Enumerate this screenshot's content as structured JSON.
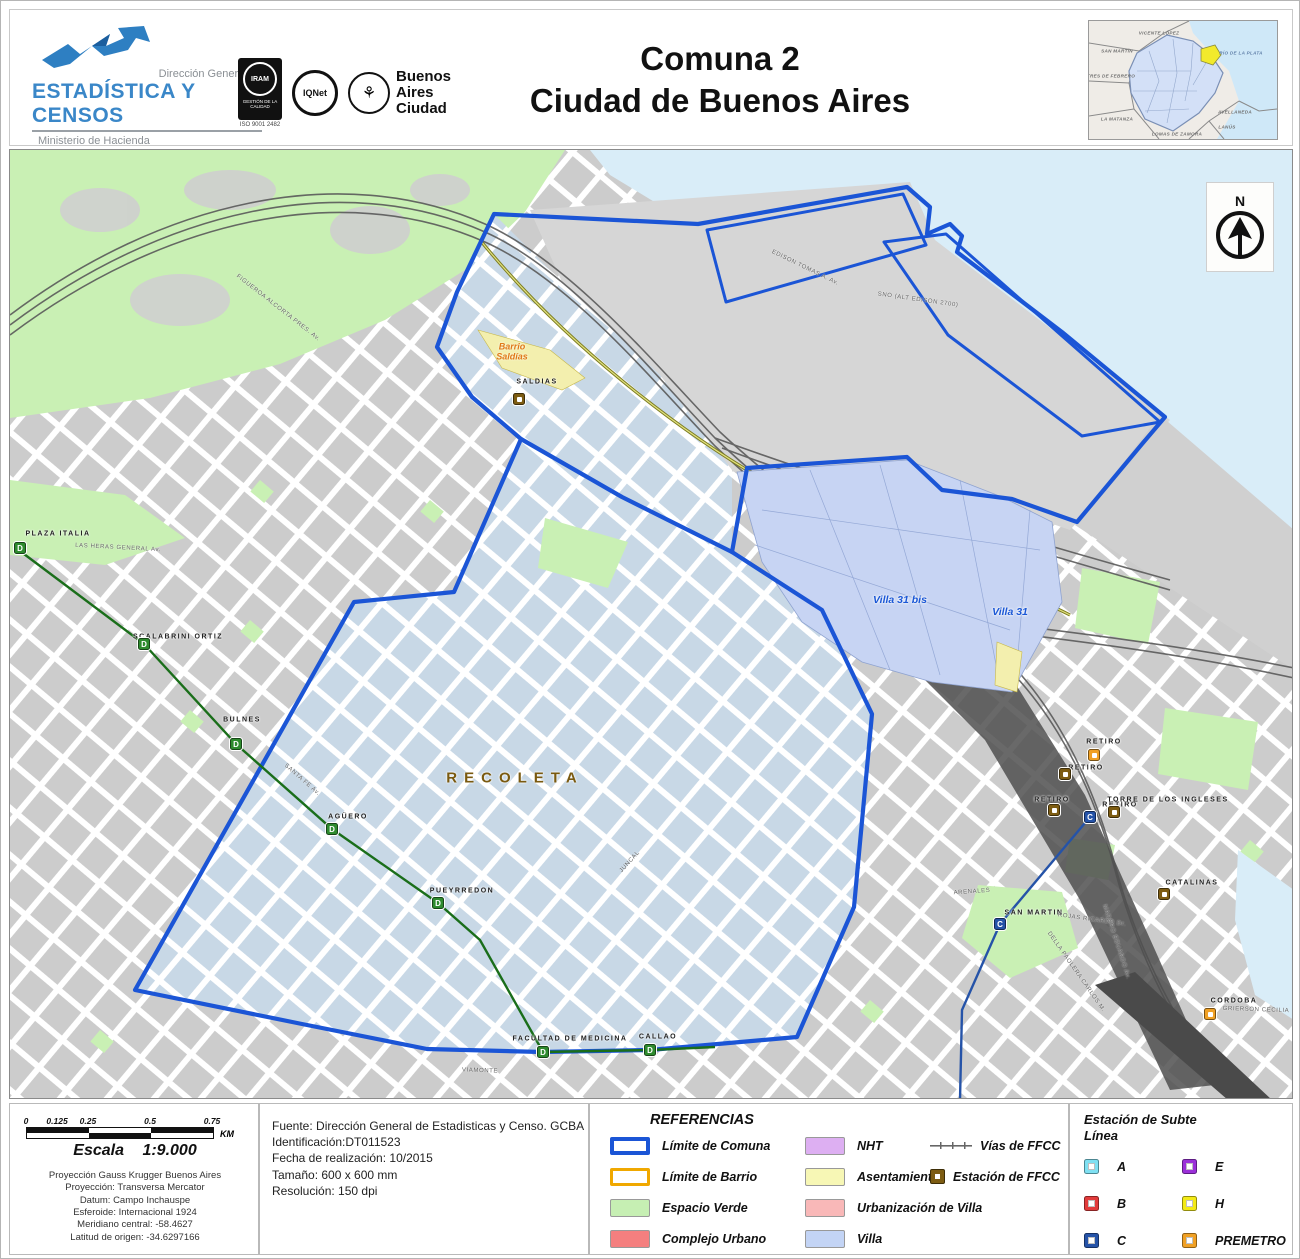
{
  "header": {
    "logo": {
      "line1": "Dirección General de",
      "line2": "ESTADÍSTICA Y CENSOS",
      "line3": "Ministerio de Hacienda"
    },
    "certs": {
      "iram": "IRAM",
      "iram_band": "GESTIÓN DE LA CALIDAD",
      "iram_code": "ISO 9001 2482",
      "iqnet": "IQNet",
      "ba1": "Buenos",
      "ba2": "Aires",
      "ba3": "Ciudad"
    },
    "title1": "Comuna 2",
    "title2": "Ciudad de Buenos Aires",
    "inset": {
      "labels": [
        {
          "text": "VICENTE LÓPEZ",
          "x": 70,
          "y": 12,
          "cls": ""
        },
        {
          "text": "SAN MARTÍN",
          "x": 28,
          "y": 30,
          "cls": ""
        },
        {
          "text": "TRES DE FEBRERO",
          "x": 22,
          "y": 55,
          "cls": ""
        },
        {
          "text": "LA MATANZA",
          "x": 28,
          "y": 98,
          "cls": ""
        },
        {
          "text": "LOMAS DE ZAMORA",
          "x": 88,
          "y": 113,
          "cls": ""
        },
        {
          "text": "LANÚS",
          "x": 138,
          "y": 106,
          "cls": ""
        },
        {
          "text": "AVELLANEDA",
          "x": 146,
          "y": 91,
          "cls": ""
        },
        {
          "text": "RÍO DE LA PLATA",
          "x": 152,
          "y": 32,
          "cls": "wl"
        }
      ]
    }
  },
  "north": {
    "label": "N"
  },
  "map": {
    "labels": [
      {
        "text": "RECOLETA",
        "x": 505,
        "y": 628,
        "cls": "region",
        "rot": 0
      },
      {
        "text": "Villa 31 bis",
        "x": 890,
        "y": 450,
        "cls": "villa-l",
        "rot": 0
      },
      {
        "text": "Villa 31",
        "x": 1000,
        "y": 462,
        "cls": "villa-l",
        "rot": 0
      },
      {
        "text": "Barrio\nSaldías",
        "x": 502,
        "y": 202,
        "cls": "orange-l",
        "rot": 0
      },
      {
        "text": "SALDIAS",
        "x": 527,
        "y": 232,
        "cls": "stn",
        "rot": 0
      },
      {
        "text": "PLAZA ITALIA",
        "x": 48,
        "y": 384,
        "cls": "stn",
        "rot": 0
      },
      {
        "text": "SCALABRINI ORTIZ",
        "x": 168,
        "y": 487,
        "cls": "stn",
        "rot": 0
      },
      {
        "text": "BULNES",
        "x": 232,
        "y": 570,
        "cls": "stn",
        "rot": 0
      },
      {
        "text": "AGÜERO",
        "x": 338,
        "y": 667,
        "cls": "stn",
        "rot": 0
      },
      {
        "text": "PUEYRREDON",
        "x": 452,
        "y": 741,
        "cls": "stn",
        "rot": 0
      },
      {
        "text": "FACULTAD DE MEDICINA",
        "x": 560,
        "y": 889,
        "cls": "stn",
        "rot": 0
      },
      {
        "text": "CALLAO",
        "x": 648,
        "y": 887,
        "cls": "stn",
        "rot": 0
      },
      {
        "text": "RETIRO",
        "x": 1094,
        "y": 592,
        "cls": "stn",
        "rot": 0
      },
      {
        "text": "RETIRO",
        "x": 1076,
        "y": 618,
        "cls": "stn",
        "rot": 0
      },
      {
        "text": "RETIRO",
        "x": 1042,
        "y": 650,
        "cls": "stn",
        "rot": 0
      },
      {
        "text": "RETIRO",
        "x": 1110,
        "y": 655,
        "cls": "stn",
        "rot": 0
      },
      {
        "text": "TORRE DE LOS INGLESES",
        "x": 1158,
        "y": 650,
        "cls": "stn",
        "rot": 0
      },
      {
        "text": "SAN MARTIN",
        "x": 1024,
        "y": 763,
        "cls": "stn",
        "rot": 0
      },
      {
        "text": "CATALINAS",
        "x": 1182,
        "y": 733,
        "cls": "stn",
        "rot": 0
      },
      {
        "text": "CORDOBA",
        "x": 1224,
        "y": 851,
        "cls": "stn",
        "rot": 0
      },
      {
        "text": "LAS HERAS GENERAL Av.",
        "x": 108,
        "y": 398,
        "cls": "street",
        "rot": 3
      },
      {
        "text": "SANTA FE Av.",
        "x": 292,
        "y": 630,
        "cls": "street",
        "rot": 41
      },
      {
        "text": "VIAMONTE",
        "x": 470,
        "y": 921,
        "cls": "street",
        "rot": 2
      },
      {
        "text": "EDISON TOMAS A. Av.",
        "x": 795,
        "y": 118,
        "cls": "street",
        "rot": 26
      },
      {
        "text": "SNO (ALT EDISON 2700)",
        "x": 908,
        "y": 150,
        "cls": "street",
        "rot": 8
      },
      {
        "text": "FIGUEROA ALCORTA PRES. Av.",
        "x": 268,
        "y": 158,
        "cls": "street",
        "rot": 38
      },
      {
        "text": "MADERO EDUARDO Av.",
        "x": 1106,
        "y": 792,
        "cls": "street",
        "rot": 72
      },
      {
        "text": "DELLA PAOLERA CARLOS M.",
        "x": 1066,
        "y": 822,
        "cls": "street",
        "rot": 55
      },
      {
        "text": "ROJAS RICARDO Dr.",
        "x": 1082,
        "y": 770,
        "cls": "street",
        "rot": 8
      },
      {
        "text": "GRIERSON CECILIA",
        "x": 1246,
        "y": 860,
        "cls": "street",
        "rot": 2
      },
      {
        "text": "ARENALES",
        "x": 962,
        "y": 742,
        "cls": "street",
        "rot": -4
      },
      {
        "text": "JUNCAL",
        "x": 620,
        "y": 712,
        "cls": "street",
        "rot": -48
      }
    ],
    "stations": [
      {
        "x": 10,
        "y": 398,
        "kind": "subte",
        "color": "#2e8b2e",
        "letter": "D"
      },
      {
        "x": 134,
        "y": 494,
        "kind": "subte",
        "color": "#2e8b2e",
        "letter": "D"
      },
      {
        "x": 226,
        "y": 594,
        "kind": "subte",
        "color": "#2e8b2e",
        "letter": "D"
      },
      {
        "x": 322,
        "y": 679,
        "kind": "subte",
        "color": "#2e8b2e",
        "letter": "D"
      },
      {
        "x": 428,
        "y": 753,
        "kind": "subte",
        "color": "#2e8b2e",
        "letter": "D"
      },
      {
        "x": 533,
        "y": 902,
        "kind": "subte",
        "color": "#2e8b2e",
        "letter": "D"
      },
      {
        "x": 640,
        "y": 900,
        "kind": "subte",
        "color": "#2e8b2e",
        "letter": "D"
      },
      {
        "x": 1080,
        "y": 667,
        "kind": "subte",
        "color": "#2553a8",
        "letter": "C"
      },
      {
        "x": 990,
        "y": 774,
        "kind": "subte",
        "color": "#2553a8",
        "letter": "C"
      },
      {
        "x": 509,
        "y": 249,
        "kind": "ffcc",
        "color": "#7d5c12",
        "letter": ""
      },
      {
        "x": 1055,
        "y": 624,
        "kind": "ffcc",
        "color": "#7d5c12",
        "letter": ""
      },
      {
        "x": 1044,
        "y": 660,
        "kind": "ffcc",
        "color": "#7d5c12",
        "letter": ""
      },
      {
        "x": 1104,
        "y": 662,
        "kind": "ffcc",
        "color": "#7d5c12",
        "letter": ""
      },
      {
        "x": 1154,
        "y": 744,
        "kind": "ffcc",
        "color": "#7d5c12",
        "letter": ""
      },
      {
        "x": 1084,
        "y": 605,
        "kind": "premetro",
        "color": "#f0a024",
        "letter": ""
      },
      {
        "x": 1200,
        "y": 864,
        "kind": "premetro",
        "color": "#f0a024",
        "letter": ""
      }
    ]
  },
  "footer": {
    "scale": {
      "ticks": [
        {
          "value": "0",
          "pos": 0
        },
        {
          "value": "0.125",
          "pos": 16.7
        },
        {
          "value": "0.25",
          "pos": 33.3
        },
        {
          "value": "0.5",
          "pos": 66.7
        },
        {
          "value": "0.75",
          "pos": 100
        }
      ],
      "unit": "KM",
      "escala_label": "Escala",
      "escala_value": "1:9.000",
      "proj": [
        "Proyección Gauss Krugger Buenos Aires",
        "Proyección: Transversa Mercator",
        "Datum: Campo Inchauspe",
        "Esferoide: Internacional 1924",
        "Meridiano central: -58.4627",
        "Latitud de origen: -34.6297166"
      ]
    },
    "source": {
      "lines": [
        "Fuente: Dirección General de Estadisticas y Censo. GCBA",
        "Identificación:DT011523",
        "Fecha de realización: 10/2015",
        "Tamaño: 600 x 600 mm",
        "Resolución: 150 dpi"
      ]
    },
    "references": {
      "title": "REFERENCIAS",
      "col1": [
        {
          "label": "Límite de Comuna",
          "type": "outline",
          "color": "#1b55d6",
          "bw": 4
        },
        {
          "label": "Límite de Barrio",
          "type": "outline",
          "color": "#f0a800",
          "bw": 3
        },
        {
          "label": "Espacio Verde",
          "type": "fill",
          "color": "#c6efb3"
        },
        {
          "label": "Complejo Urbano",
          "type": "fill",
          "color": "#f47f7f"
        }
      ],
      "col2": [
        {
          "label": "NHT",
          "type": "fill",
          "color": "#ddaff2"
        },
        {
          "label": "Asentamiento",
          "type": "fill",
          "color": "#f7f7b5"
        },
        {
          "label": "Urbanización de Villa",
          "type": "fill",
          "color": "#f9b8b8"
        },
        {
          "label": "Villa",
          "type": "fill",
          "color": "#c3d4f5"
        }
      ],
      "vias_label": "Vías de FFCC",
      "estacion_label": "Estación de FFCC"
    },
    "subte": {
      "title1": "Estación de Subte",
      "title2": "Línea",
      "colA": [
        {
          "letter": "A",
          "color": "#7fe0f2"
        },
        {
          "letter": "B",
          "color": "#e23b3b"
        },
        {
          "letter": "C",
          "color": "#2553a8"
        },
        {
          "letter": "D",
          "color": "#2e8b2e"
        }
      ],
      "colB": [
        {
          "letter": "E",
          "color": "#9b30d9"
        },
        {
          "letter": "H",
          "color": "#f3ea16"
        },
        {
          "letter": "PREMETRO",
          "color": "#f0a024"
        }
      ]
    }
  },
  "colors": {
    "water": "#d9edf8",
    "green": "#c9f0b4",
    "block_gray": "#cccccc",
    "comuna_block": "#c8d8e6",
    "villa_fill": "#c7d4f3",
    "asentamiento_fill": "#f3efae",
    "comuna_line": "#1b55d6",
    "rail": "#5a5a5a"
  }
}
